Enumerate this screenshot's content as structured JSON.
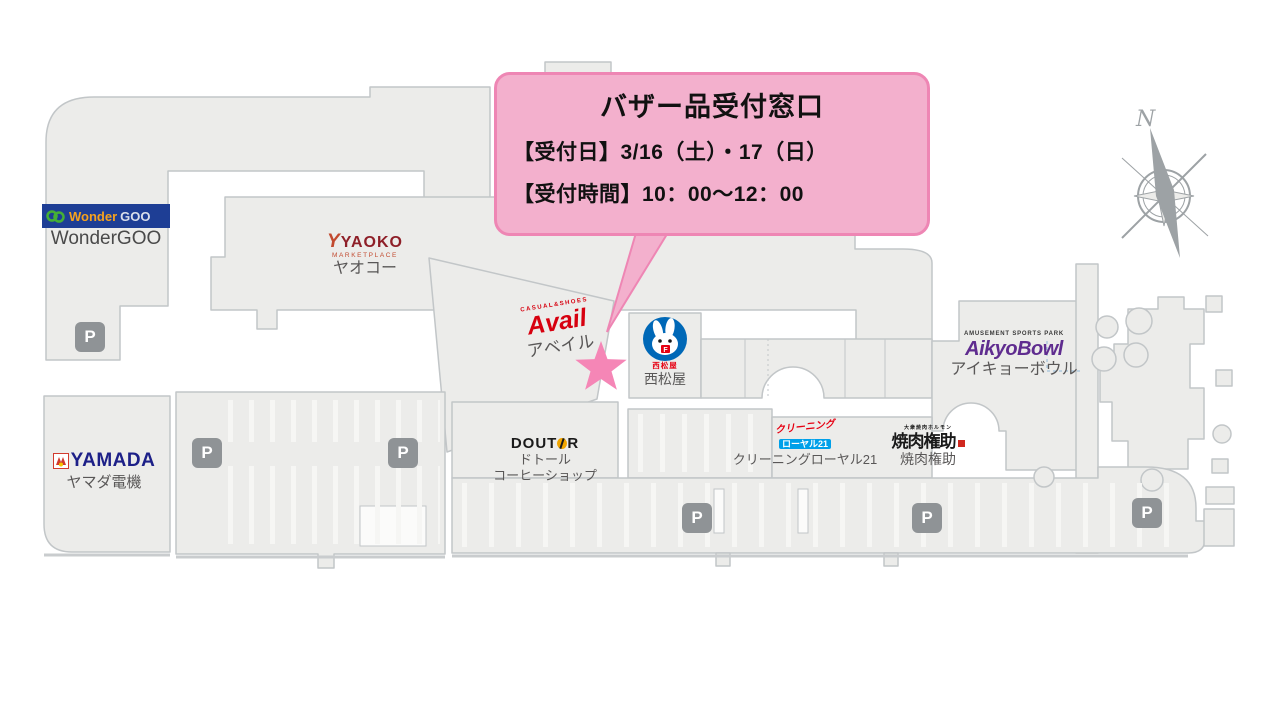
{
  "callout": {
    "title": "バザー品受付窓口",
    "line1": "【受付日】3/16（土）・17（日）",
    "line2": "【受付時間】10：00〜12：00"
  },
  "compass": {
    "label": "N"
  },
  "parking": {
    "label": "P"
  },
  "stores": {
    "wondergoo": {
      "logo_wonder": "Wonder",
      "logo_goo": "GOO",
      "name": "WonderGOO"
    },
    "yaoko": {
      "mark": "Y",
      "logo": "YAOKO",
      "sub": "MARKETPLACE",
      "name": "ヤオコー"
    },
    "avail": {
      "tagline": "CASUAL&SHOES",
      "logo": "Avail",
      "name": "アベイル"
    },
    "nishimatsuya": {
      "flag": "F",
      "logo_small": "西松屋",
      "name": "西松屋"
    },
    "aikyobowl": {
      "tagline": "AMUSEMENT SPORTS PARK",
      "logo": "AikyoBowl",
      "name": "アイキョーボウル"
    },
    "yamada": {
      "logo": "YAMADA",
      "name": "ヤマダ電機"
    },
    "doutor": {
      "logo_left": "DOUT",
      "logo_right": "R",
      "name_line1": "ドトール",
      "name_line2": "コーヒーショップ"
    },
    "royal21": {
      "logo_top": "クリーニング",
      "logo_bottom": "ローヤル21",
      "name": "クリーニングローヤル21"
    },
    "gonsuke": {
      "tagline": "大衆焼肉ホルモン",
      "logo": "焼肉権助",
      "name": "焼肉権助"
    }
  },
  "colors": {
    "callout_fill": "#F3B0CD",
    "callout_border": "#EE86B4",
    "star_marker": "#F586B6",
    "building_fill": "#ECECEA",
    "building_border": "#C2C6C8",
    "parking_badge": "#8F9396",
    "compass_gray": "#9DA2A5"
  }
}
